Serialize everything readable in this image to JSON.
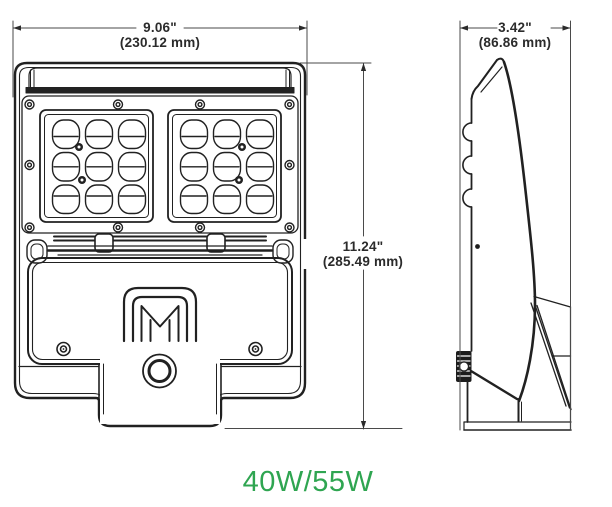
{
  "dimensions": {
    "width": {
      "inches": "9.06\"",
      "mm": "(230.12 mm)"
    },
    "height": {
      "inches": "11.24\"",
      "mm": "(285.49 mm)"
    },
    "depth": {
      "inches": "3.42\"",
      "mm": "(86.86 mm)"
    }
  },
  "wattage_label": "40W/55W",
  "logo_letter": "M",
  "colors": {
    "line": "#212121",
    "dimension_text": "#2b2b2b",
    "accent_green": "#2fa551"
  },
  "icons": {
    "logo": "m-logo-icon",
    "screw": "screw-icon",
    "photocell": "photocell-port",
    "knob": "adjustment-knob"
  }
}
